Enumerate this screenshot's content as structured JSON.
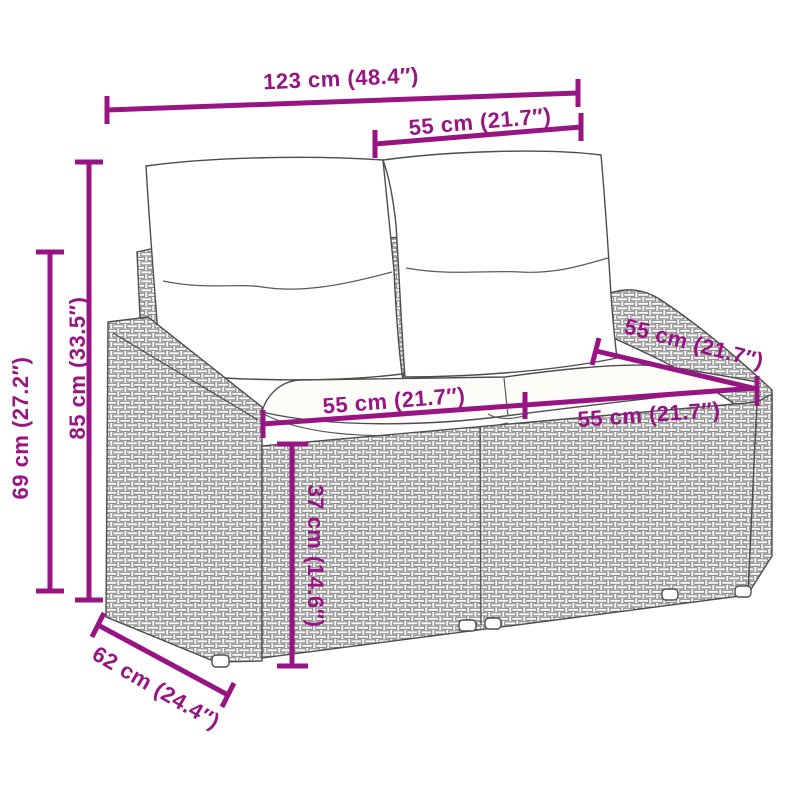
{
  "accent_color": "#991483",
  "drawing_line_color": "#4d4d4d",
  "diagram_type": "product dimension line drawing (2-seater rattan garden sofa with cushions)",
  "dimensions": {
    "total_width": {
      "label": "123 cm (48.4″)",
      "cm": 123,
      "inches": 48.4
    },
    "backrest_width": {
      "label": "55 cm (21.7″)",
      "cm": 55,
      "inches": 21.7
    },
    "total_height": {
      "label": "85 cm (33.5″)",
      "cm": 85,
      "inches": 33.5
    },
    "arm_height": {
      "label": "69 cm (27.2″)",
      "cm": 69,
      "inches": 27.2
    },
    "seat_width_left": {
      "label": "55 cm (21.7″)",
      "cm": 55,
      "inches": 21.7
    },
    "seat_width_right": {
      "label": "55 cm (21.7″)",
      "cm": 55,
      "inches": 21.7
    },
    "seat_depth": {
      "label": "55 cm (21.7″)",
      "cm": 55,
      "inches": 21.7
    },
    "seat_height": {
      "label": "37 cm (14.6″)",
      "cm": 37,
      "inches": 14.6
    },
    "total_depth": {
      "label": "62 cm (24.4″)",
      "cm": 62,
      "inches": 24.4
    }
  }
}
